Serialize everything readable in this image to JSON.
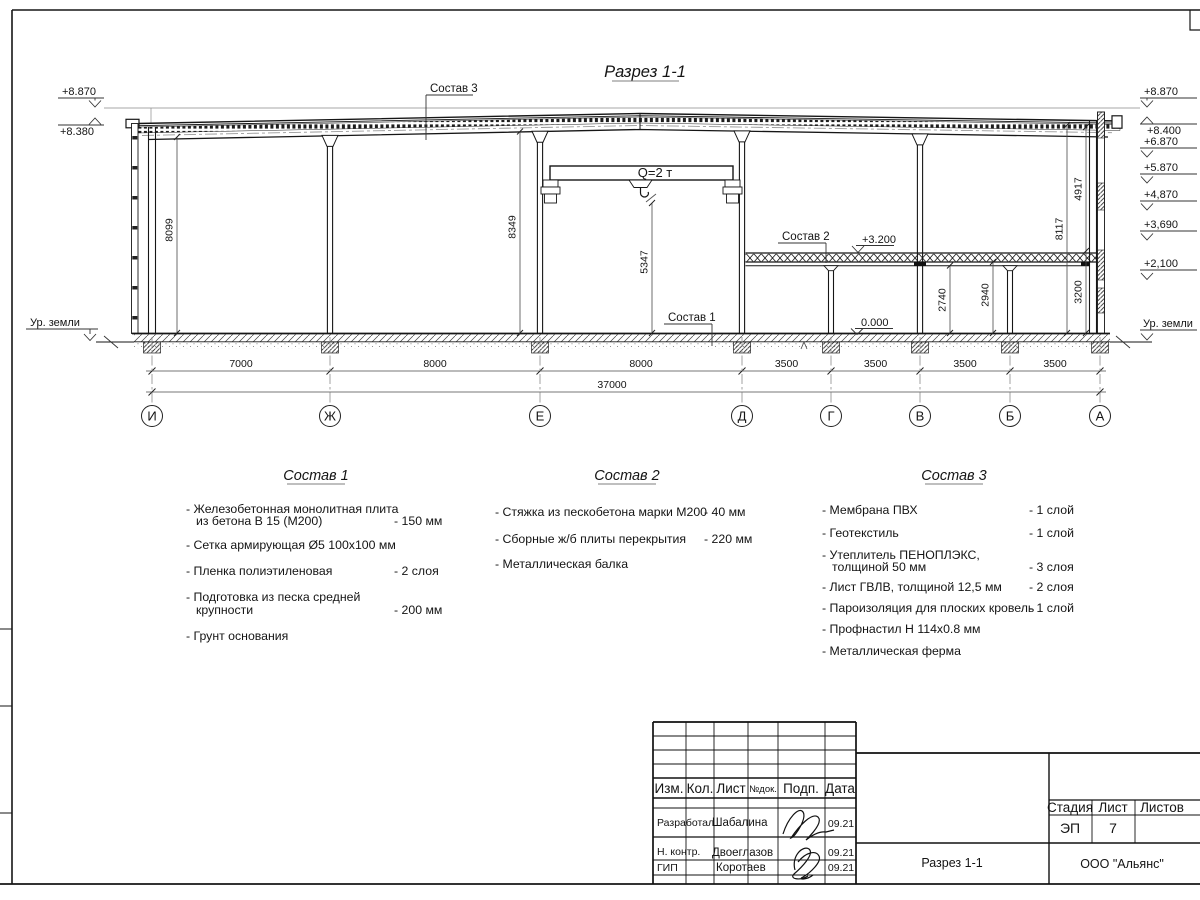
{
  "drawing": {
    "title": "Разрез 1-1",
    "crane_label": "Q=2 т",
    "callouts": {
      "c1": "Состав 1",
      "c2": "Состав 2",
      "c3": "Состав 3"
    },
    "levels_left": {
      "l1": "+8.870",
      "l2": "+8.380",
      "ground": "Ур. земли"
    },
    "levels_right": {
      "l1": "+8.870",
      "l2": "+8.400",
      "l3": "+6.870",
      "l4": "+5.870",
      "l5": "+4,870",
      "l6": "+3,690",
      "l7": "+2,100",
      "ground": "Ур. земли"
    },
    "levels_mid": {
      "mezz": "+3.200",
      "zero": "0.000"
    },
    "vdims": {
      "d8099": "8099",
      "d8349": "8349",
      "d5347": "5347",
      "d2740": "2740",
      "d2940": "2940",
      "d3200": "3200",
      "d4917": "4917",
      "d8117": "8117"
    },
    "hdims": [
      "7000",
      "8000",
      "8000",
      "3500",
      "3500",
      "3500",
      "3500"
    ],
    "total_dim": "37000",
    "axes": [
      "И",
      "Ж",
      "Е",
      "Д",
      "Г",
      "В",
      "Б",
      "А"
    ]
  },
  "compositions": [
    {
      "title": "Состав 1",
      "items": [
        {
          "l1": "- Железобетонная  монолитная плита",
          "l2": "из бетона В 15 (М200)",
          "value": "- 150 мм"
        },
        {
          "l1": "- Сетка армирующая Ø5 100х100 мм",
          "l2": "",
          "value": ""
        },
        {
          "l1": "- Пленка полиэтиленовая",
          "l2": "",
          "value": "- 2 слоя"
        },
        {
          "l1": "- Подготовка из песка средней",
          "l2": "крупности",
          "value": "- 200 мм"
        },
        {
          "l1": "- Грунт основания",
          "l2": "",
          "value": ""
        }
      ]
    },
    {
      "title": "Состав 2",
      "items": [
        {
          "l1": "- Стяжка из пескобетона марки М200",
          "value": "- 40 мм"
        },
        {
          "l1": "- Сборные ж/б плиты перекрытия",
          "value": "- 220 мм"
        },
        {
          "l1": "- Металлическая балка",
          "value": ""
        }
      ]
    },
    {
      "title": "Состав 3",
      "items": [
        {
          "l1": "- Мембрана ПВХ",
          "l2": "",
          "value": "- 1 слой"
        },
        {
          "l1": "- Геотекстиль",
          "l2": "",
          "value": "- 1 слой"
        },
        {
          "l1": "- Утеплитель ПЕНОПЛЭКС,",
          "l2": "толщиной 50 мм",
          "value": "- 3 слоя"
        },
        {
          "l1": "- Лист ГВЛВ, толщиной 12,5 мм",
          "l2": "",
          "value": "- 2 слоя"
        },
        {
          "l1": "- Пароизоляция для плоских кровель",
          "l2": "",
          "value": "- 1 слой"
        },
        {
          "l1": "- Профнастил Н 114х0.8 мм",
          "l2": "",
          "value": ""
        },
        {
          "l1": "- Металлическая ферма",
          "l2": "",
          "value": ""
        }
      ]
    }
  ],
  "titleblock": {
    "cols": [
      "Изм.",
      "Кол.",
      "Лист",
      "№док.",
      "Подп.",
      "Дата"
    ],
    "rows": [
      {
        "role": "Разработал",
        "name": "Шабалина",
        "date": "09.21"
      },
      {
        "role": "Н. контр.",
        "name": "Двоеглазов",
        "date": "09.21"
      },
      {
        "role": "ГИП",
        "name": "Коротаев",
        "date": "09.21"
      }
    ],
    "stage_label": "Стадия",
    "sheet_label": "Лист",
    "sheets_label": "Листов",
    "stage": "ЭП",
    "sheet": "7",
    "doc_name": "Разрез 1-1",
    "org": "ООО \"Альянс\""
  }
}
